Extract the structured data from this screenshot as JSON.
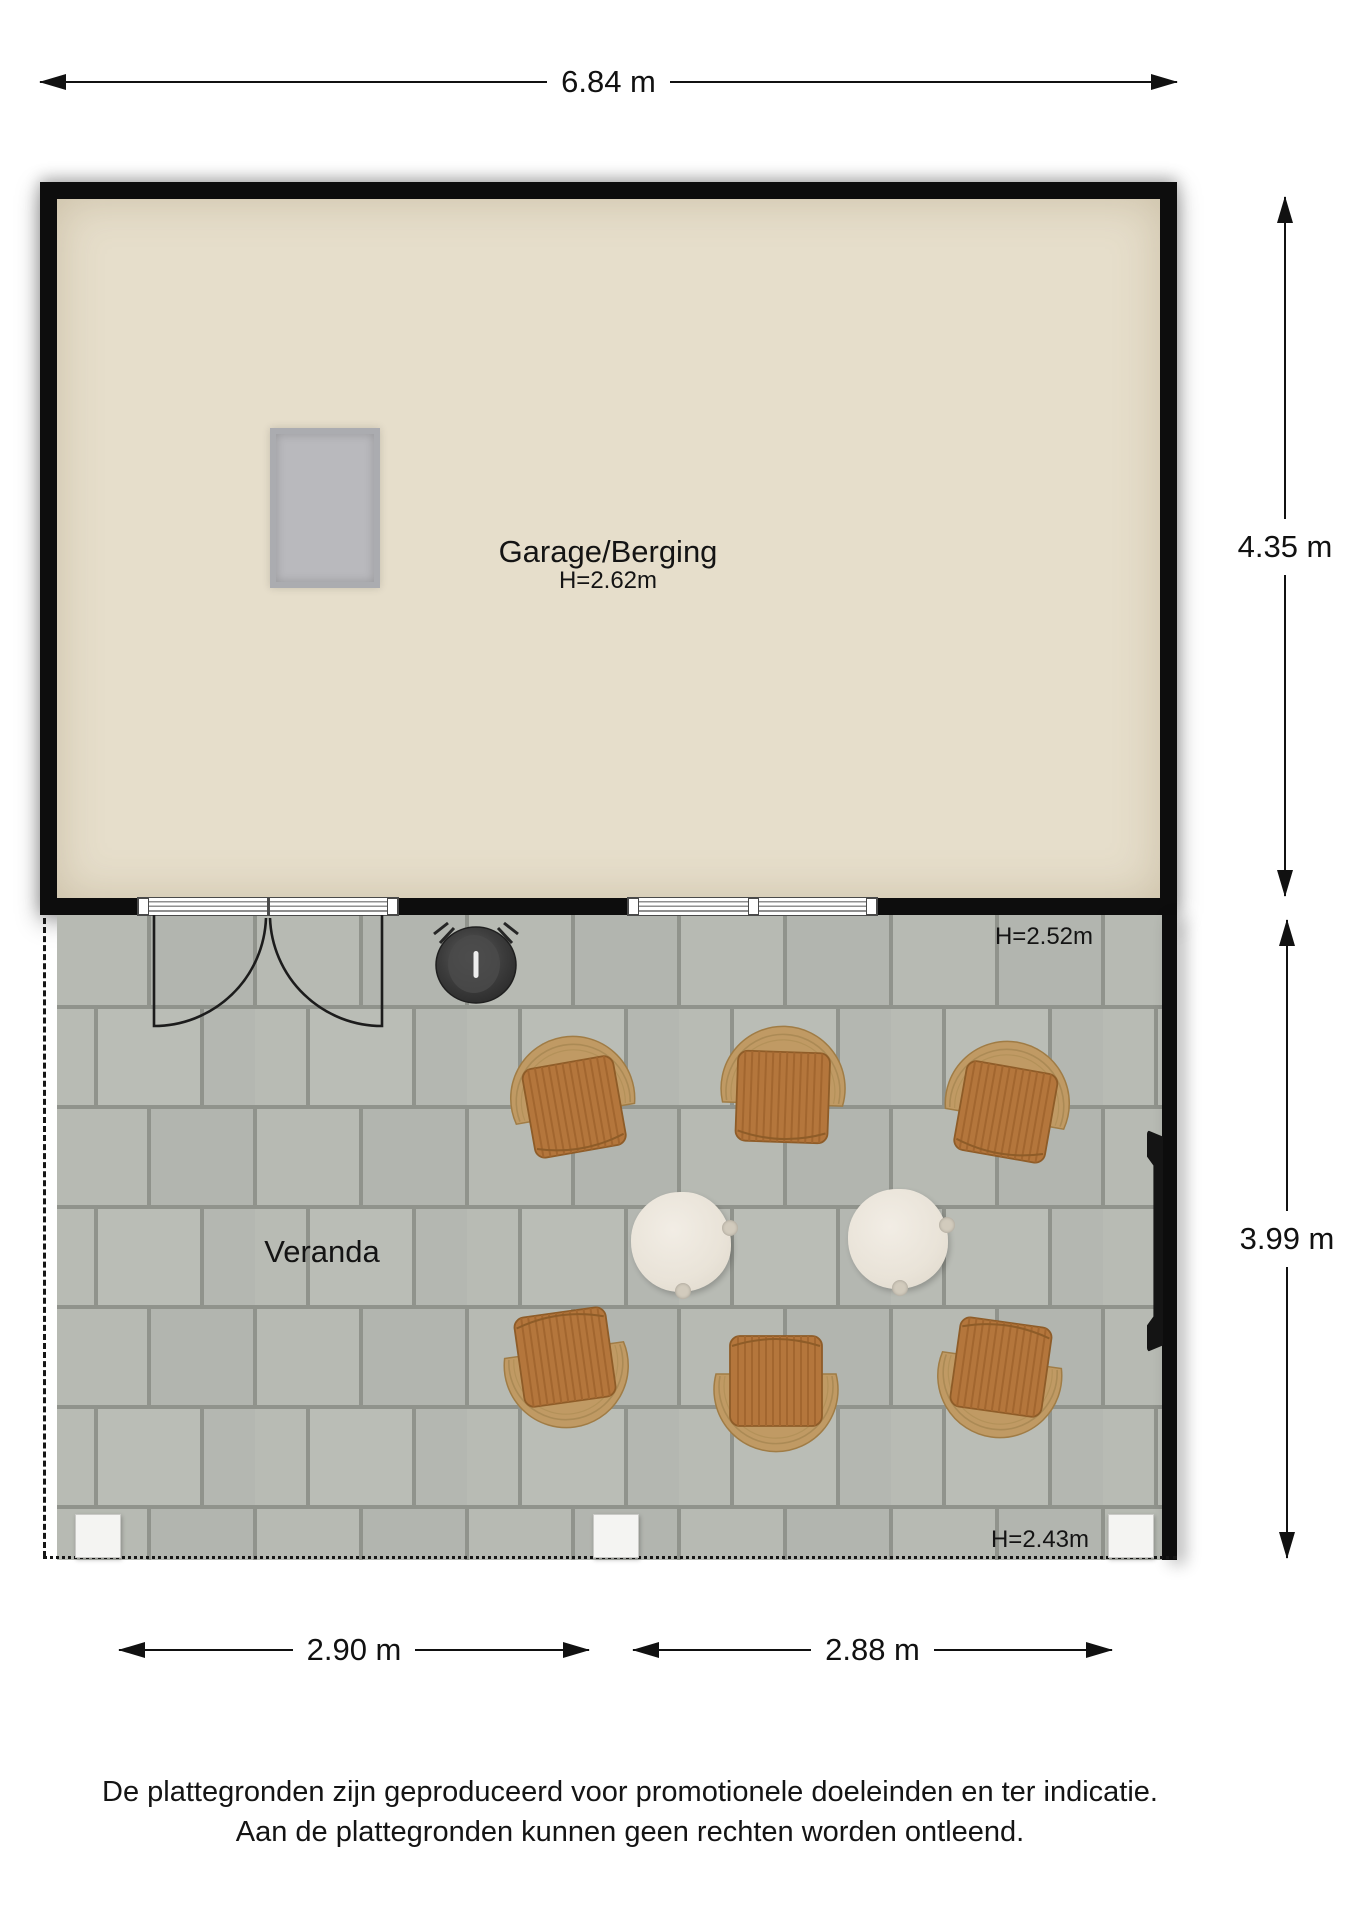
{
  "dimensions": {
    "total_width": "6.84 m",
    "garage_depth": "4.35 m",
    "veranda_depth": "3.99 m",
    "veranda_left_width": "2.90 m",
    "veranda_right_width": "2.88 m"
  },
  "rooms": {
    "garage": {
      "label": "Garage/Berging",
      "height": "H=2.62m"
    },
    "veranda": {
      "label": "Veranda",
      "height_top": "H=2.52m",
      "height_bottom": "H=2.43m"
    }
  },
  "footer": {
    "line1": "De plattegronden zijn geproduceerd voor promotionele doeleinden en ter indicatie.",
    "line2": "Aan de plattegronden kunnen geen rechten worden ontleend."
  },
  "colors": {
    "wall": "#0d0d0d",
    "garage_floor": "#e6decb",
    "skylight": "#b9b9bd",
    "paver": "#b6b9b2",
    "grout": "#90938c",
    "chair_wood": "#b4763c",
    "chair_rattan": "#c09a64",
    "table": "#ece6dc",
    "bbq": "#3c3c3c"
  }
}
